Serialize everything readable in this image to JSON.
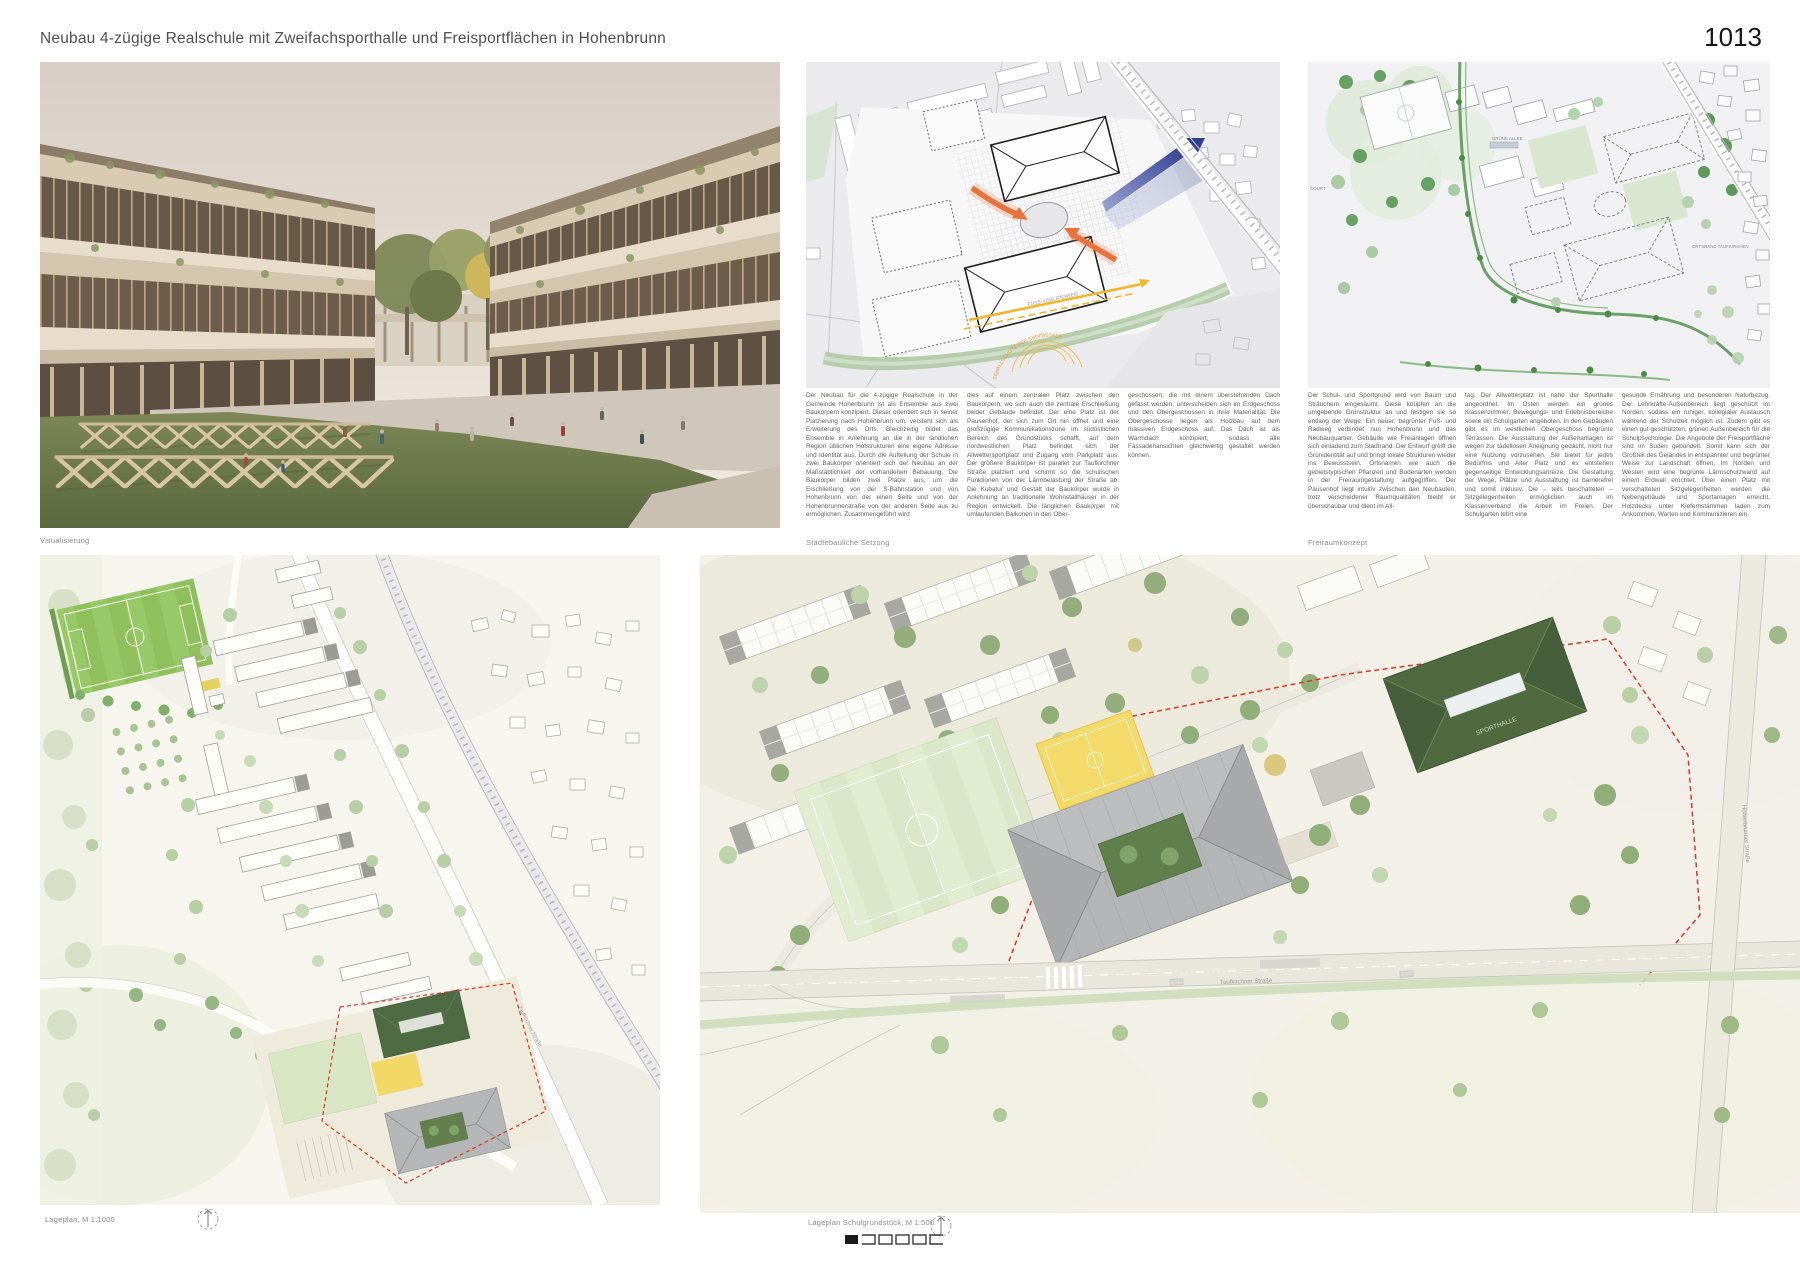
{
  "header": {
    "title": "Neubau 4-zügige Realschule mit Zweifachsporthalle und Freisportflächen in Hohenbrunn",
    "sheet_number": "1013"
  },
  "panels": {
    "visualization": {
      "caption": "Visualisierung"
    },
    "urban_diagram": {
      "caption": "Städtebauliche Setzung",
      "labels": {
        "radweg": "FUSS- UND RADWEG",
        "schallschutz": "SCHALLSCHUTZ DER SÜDFASSADE"
      },
      "text_columns": [
        "Der Neubau für die 4-zügige Realschule in der Gemeinde Hohenbrunn ist als Ensemble aus zwei Baukörpern konzipiert. Dieser orientiert sich in seiner Platzierung nach Hohenbrunn um, versteht sich als Erweiterung des Orts. Gleichzeitig bildet das Ensemble in Anlehnung an die in der ländlichen Region üblichen Hofstrukturen eine eigene Adresse und Identität aus. Durch die Aufteilung der Schule in zwei Baukörper orientiert sich der Neubau an der Maßstäblichkeit der vorhandenen Bebauung. Die Baukörper bilden zwei Plätze aus, um die Erschließung von der S-Bahnstation und von Hohenbrunn von der einen Seite und von der Hohenbrunnerstraße von der anderen Seite aus zu ermöglichen. Zusammengeführt wird",
        "dies auf einem zentralen Platz zwischen den Baukörpern, wo sich auch die zentrale Erschließung beider Gebäude befindet. Der eine Platz ist der Pausenhof, der sich zum Ort hin öffnet und eine großzügige Kommunikationszone im südöstlichen Bereich des Grundstücks schafft, auf dem nordwestlichen Platz befindet sich der Allwettersportplatz und Zugang vom Parkplatz aus. Der größere Baukörper ist parallel zur Taufkirchner Straße platziert und schirmt so die schulischen Funktionen von der Lärmbelastung der Straße ab. Die Kubatur und Gestalt der Baukörper wurde in Anlehnung an traditionelle Wohnstallhäuser in der Region entwickelt. Die länglichen Baukörper mit umlaufenden Balkonen in den Ober-",
        "geschossen, die mit einem überstehenden Dach gefasst werden, unterscheiden sich im Erdgeschoss und den Obergeschossen in ihrer Materialität. Die Obergeschosse liegen als Holzbau auf dem massiven Erdgeschoss auf. Das Dach ist als Warmdach konzipiert, sodass alle Fassadenansichten gleichwertig gestaltet werden können."
      ]
    },
    "landscape_diagram": {
      "caption": "Freiraumkonzept",
      "labels": {
        "court": "COURT",
        "allee": "GRÜNE ALLEE",
        "ortsrand": "ORTSRAND TAUFKIRCHEN"
      },
      "text_columns": [
        "Der Schul- und Sportgrund wird von Baum und Sträuchern eingesäumt. Diese knüpfen an die umgebende Grünstruktur an und festigen sie so entlang der Wege. Ein neuer, begrünter Fuß- und Radweg verbindet nun Hohenbrunn und das Neubauquartier. Gebäude wie Freianlagen öffnen sich einladend zum Stadtrand. Der Entwurf greift die Grünidentität auf und bringt lokale Strukturen wieder ins Bewusstsein. Ortsnamen wie auch die gebietstypischen Pflanzen und Bodenarten werden in der Freiraumgestaltung aufgegriffen. Der Pausenhof liegt intuitiv zwischen den Neubauten, trotz verschiedener Raumqualitäten bleibt er überschaubar und dient im All-",
        "tag. Der Allwetterplatz ist nahe der Sporthalle angeordnet. Im Osten werden ein grünes Klassenzimmer, Bewegungs- und Erlebnisbereiche sowie ein Schulgarten angeboten. In den Gebäuden gibt es im westlichen Obergeschoss begrünte Terrassen. Die Ausstattung der Außenanlagen ist wegen zur tadellosen Aneignung gedacht, nicht nur eine Nutzung vorzusehen. Sie bietet für jedes Bedürfnis und Alter Platz und es entstehen gegenseitige Entwicklungsanreize. Die Gestaltung der Wege, Plätze und Ausstattung ist barrierefrei und somit inklusiv. Die – teils beschatteten – Sitzgelegenheiten ermöglichen auch im Klassenverband die Arbeit im Freien. Der Schulgarten lehrt eine",
        "gesunde Ernährung und besonderen Naturbezug. Der Lehrkräfte-Außenbereich liegt geschützt im Norden, sodass ein ruhiger, kollegialer Austausch während der Schulzeit möglich ist. Zudem gibt es einen gut geschützten, grünen Außenbereich für die Schulpsychologie. Die Angebote der Freisportfläche sind im Süden gebündelt. Somit kann sich der Großteil des Geländes in entspannter und begrünter Weise zur Landschaft öffnen. Im Norden und Westen wird eine begrünte Lärmschutzwand auf einem Erdwall errichtet. Über einen Platz mit verschatteten Sitzgelegenheiten werden die Nebengebäude und Sportanlagen erreicht. Holzdecks unter Kiefernstämmen laden zum Ankommen, Warten und Kommunizieren ein."
      ]
    },
    "siteplan_overview": {
      "caption": "Lageplan, M 1:1000",
      "street_label": "Taufkirchner Straße"
    },
    "siteplan_detail": {
      "caption": "Lageplan Schulgrundstück, M 1:500",
      "street_label_south": "Taufkirchner Straße",
      "street_label_east": "Hohenbrunner Straße",
      "gym_label": "SPORTHALLE"
    }
  },
  "colors": {
    "accent_red": "#d6382b",
    "accent_orange": "#e8743d",
    "accent_blue": "#2e3f92",
    "accent_yellow": "#f3b628",
    "gym_green": "#4f6b44",
    "field_green": "#dbe7c8",
    "court_yellow": "#f4da69",
    "map_gray": "#ebebed"
  }
}
